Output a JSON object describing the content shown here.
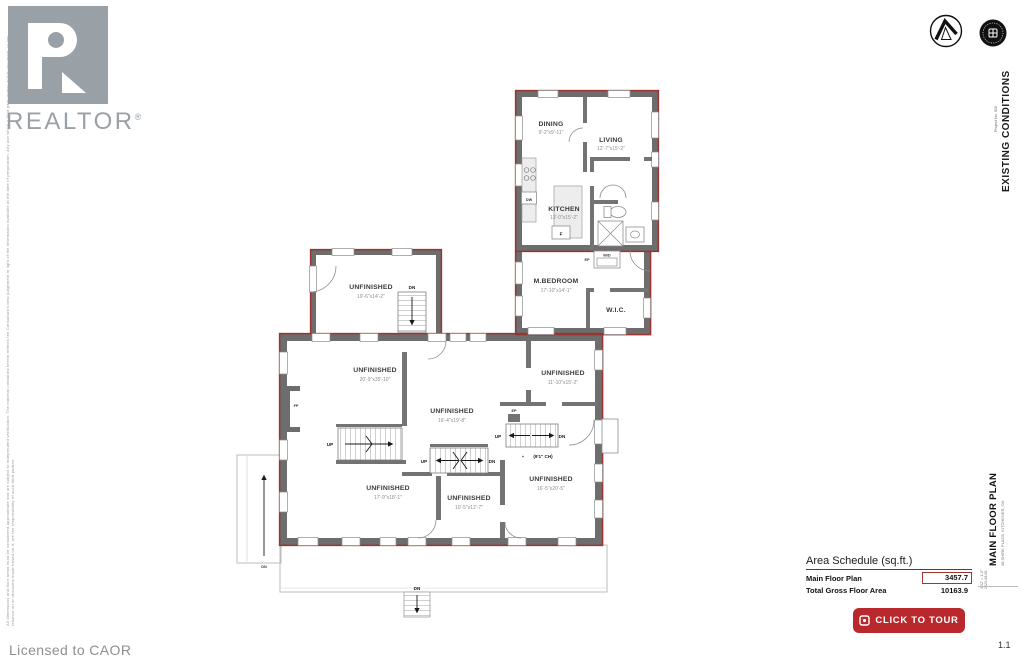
{
  "branding": {
    "realtor_wordmark": "REALTOR",
    "registered": "®",
    "licensed": "Licensed to CAOR",
    "disclaimer": "All dimensions and floor areas must be considered approximate and are subject to independent verification. The material contained herein reflects the Consultant's best judgement in light of the information available at the time of preparation. Any use which a third party makes of this document, or any reliance on or decisions made based on it, are the responsibility of such third parties."
  },
  "titleblock": {
    "existing_conditions": "EXISTING CONDITIONS",
    "project_no": "Project No. 920",
    "main_floor_plan": "MAIN FLOOR PLAN",
    "address": "38 SHIRK PLACE, KITCHENER, ON",
    "scale": "3/32\" = 1'-0\"",
    "date": "2023-08-08",
    "sheet_number": "1.1"
  },
  "area_schedule": {
    "title": "Area Schedule (sq.ft.)",
    "rows": [
      {
        "label": "Main Floor Plan",
        "value": "3457.7"
      },
      {
        "label": "Total Gross Floor Area",
        "value": "10163.9"
      }
    ]
  },
  "tour_button": {
    "label": "CLICK TO TOUR"
  },
  "colors": {
    "wall_exterior": "#6d6d6d",
    "wall_outline_red": "#9b3430",
    "accent_red": "#b8282c",
    "logo_gray": "#9aa1a6"
  },
  "floor_plan": {
    "rooms": [
      {
        "name": "DINING",
        "dims": "9'-2\"x9'-11\""
      },
      {
        "name": "LIVING",
        "dims": "12'-7\"x15'-2\""
      },
      {
        "name": "KITCHEN",
        "dims": "13'-0\"x15'-2\""
      },
      {
        "name": "M.BEDROOM",
        "dims": "17'-10\"x14'-1\""
      },
      {
        "name": "W.I.C.",
        "dims": ""
      },
      {
        "name": "UNFINISHED",
        "dims": "19'-6\"x14'-2\""
      },
      {
        "name": "UNFINISHED",
        "dims": "20'-9\"x35'-10\""
      },
      {
        "name": "UNFINISHED",
        "dims": "16'-4\"x19'-8\""
      },
      {
        "name": "UNFINISHED",
        "dims": "11'-10\"x15'-2\""
      },
      {
        "name": "UNFINISHED",
        "dims": "17'-9\"x18'-1\""
      },
      {
        "name": "UNFINISHED",
        "dims": "10'-5\"x12'-7\""
      },
      {
        "name": "UNFINISHED",
        "dims": "16'-5\"x20'-5\""
      }
    ],
    "labels": {
      "up": "UP",
      "dn": "DN",
      "fridge": "F",
      "dishwasher": "DW",
      "washer_dryer": "W/D",
      "fireplace": "FP",
      "panel": "EP",
      "ceiling_height": "(9'1\" CH)",
      "plus": "+"
    }
  }
}
